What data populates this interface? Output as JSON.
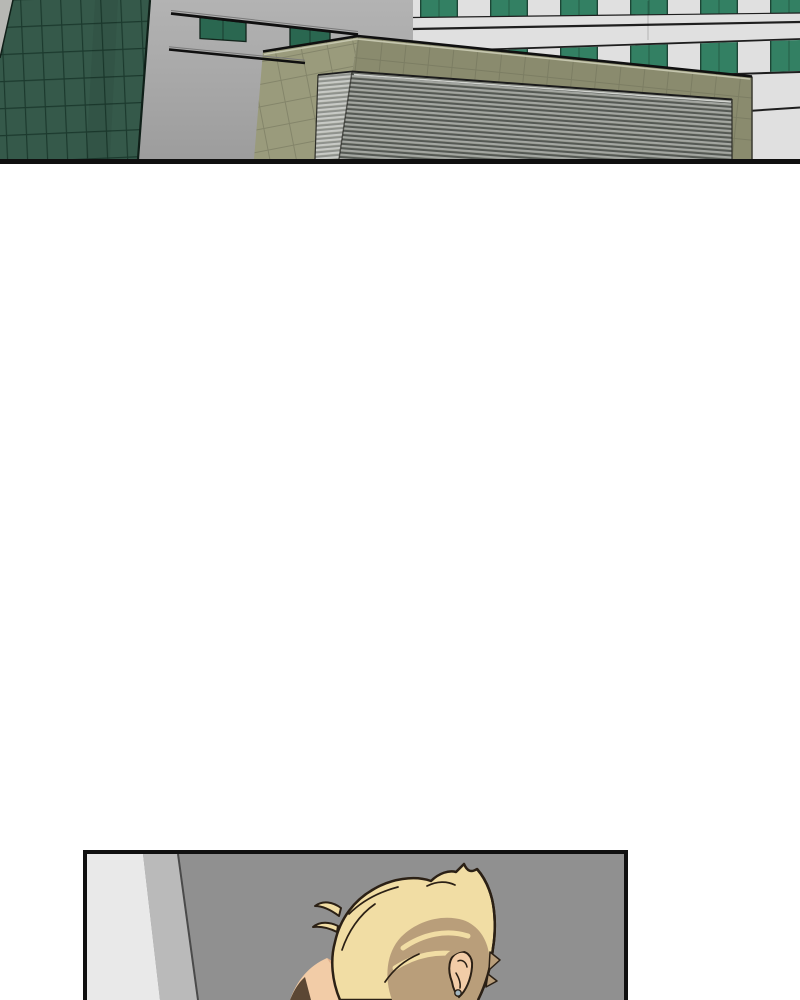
{
  "page": {
    "background": "#ffffff"
  },
  "panels": {
    "building": {
      "alt": "Exterior view: green glass tower at left, walkway rails with hanging green glass panels, low olive-tiled annex with a large corrugated metal wall, white office facade with bands of green windows behind"
    },
    "character": {
      "alt": "Top of a blonde character's bowed head with an ear stud, next to a lit wall corner in a gray room"
    }
  },
  "colors": {
    "ink": "#101010",
    "sky_top": "#B3B3B3",
    "sky_bottom": "#9C9C9C",
    "tower_green": "#35594A",
    "tower_grid": "#1C3A2E",
    "tower_edge": "#0F1F18",
    "tower_side_light": "#B7B8B4",
    "facade": "#E0E0E0",
    "facade_line": "#1E1E1E",
    "window_green": "#338063",
    "glass_panel": "#2A6750",
    "rail_highlight": "#7A7A7A",
    "olive_front": "#8A8B6E",
    "olive_left": "#9A9B7C",
    "olive_trim": "#C5C6AE",
    "olive_tile_line": "#6E6F58",
    "corr_dark": "#555954",
    "corr_light": "#A3A6A1",
    "corr_left_dark": "#8F928D",
    "corr_left_light": "#C8CAC6",
    "corr_top_light": "#D2D4D0",
    "room_bg": "#909090",
    "room_wall_light": "#E9E9E9",
    "room_wall_mid": "#BABABA",
    "room_wall_line": "#4A4A4A",
    "line": "#2B2015",
    "hair_light": "#F1DDA4",
    "hair_dark": "#B99E7A",
    "hair_gold": "#F2CD72",
    "skin": "#F2CCA7",
    "skin_shadow": "#E3B18D",
    "neck_shadow": "#5B4734",
    "earring": "#A3B6BF"
  }
}
